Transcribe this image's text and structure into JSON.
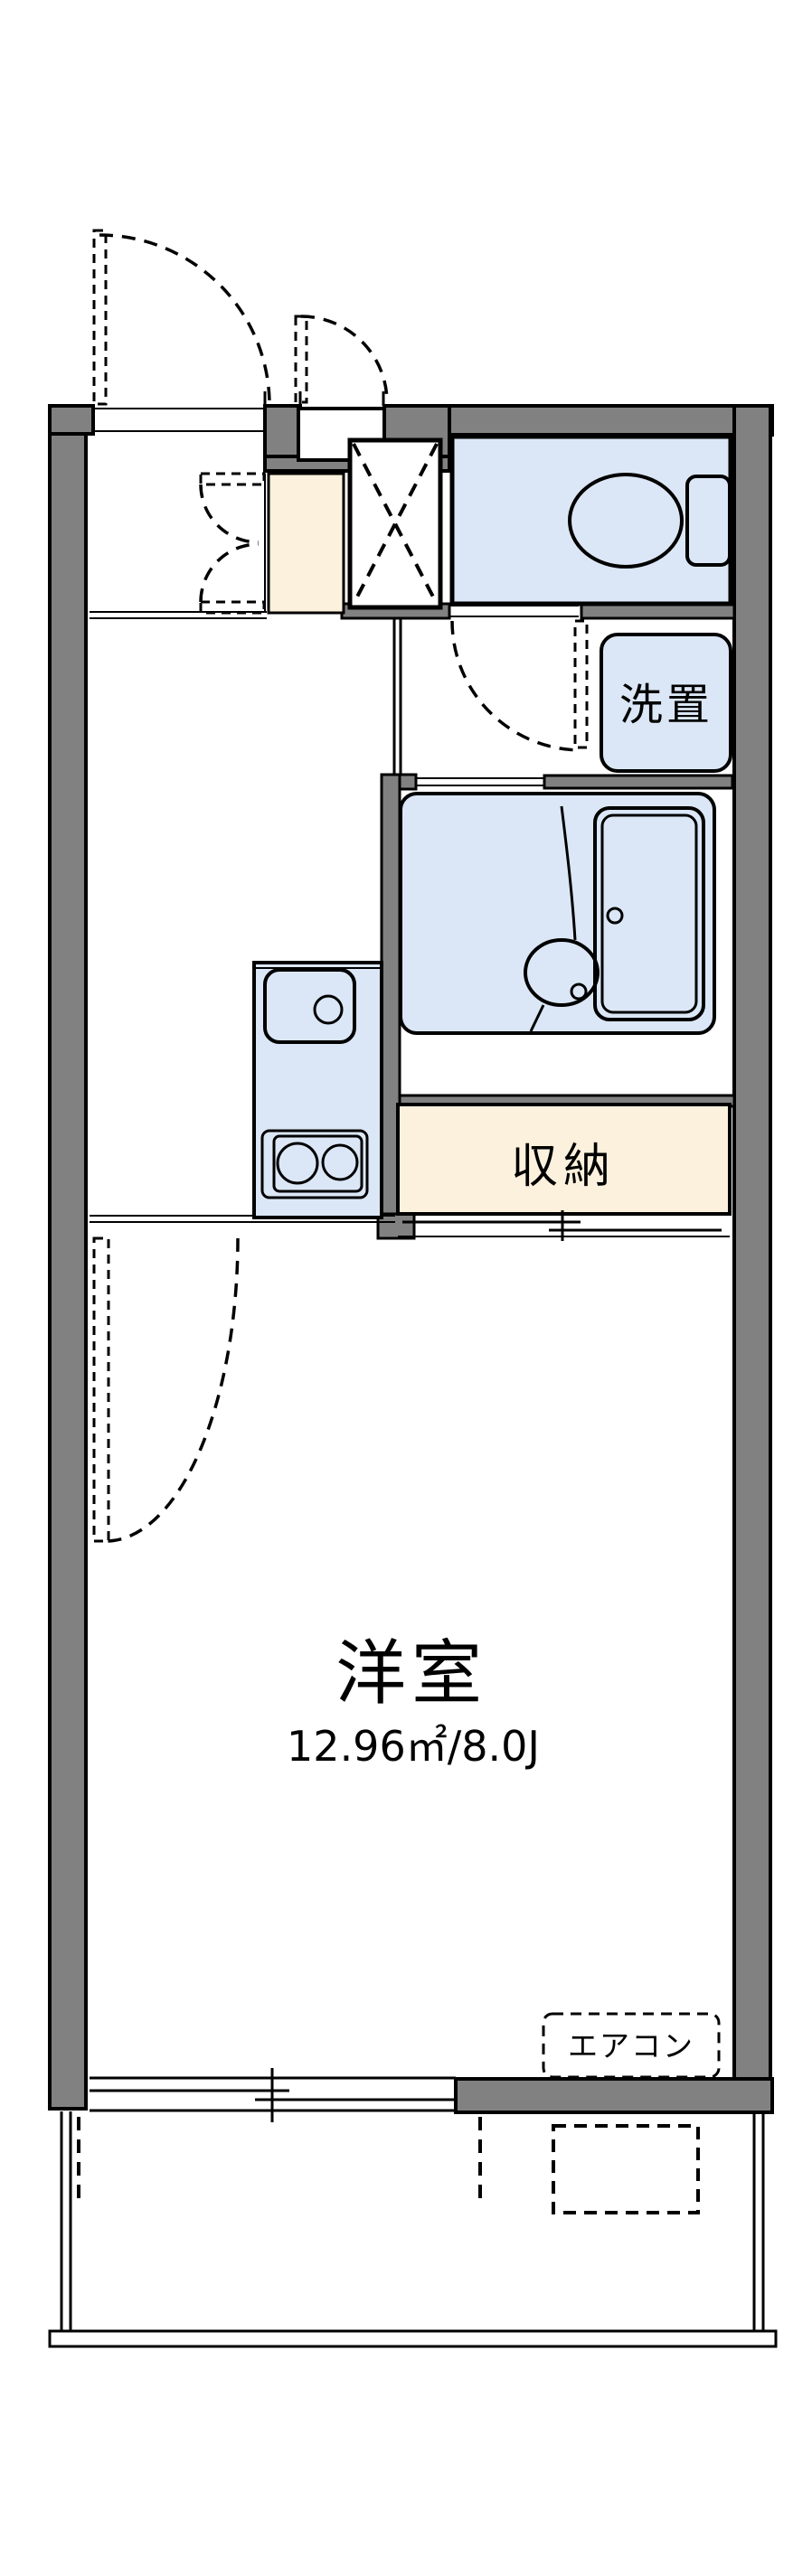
{
  "colors": {
    "wall": "#818181",
    "fixture_fill": "#dbe7f6",
    "storage_fill": "#fcf1dc",
    "line": "#000000",
    "bg": "#ffffff"
  },
  "plan": {
    "main_room": {
      "label": "洋室",
      "area": "12.96㎡/8.0J"
    },
    "storage": {
      "label": "収納"
    },
    "washer_space": {
      "label": "洗置"
    },
    "air_conditioner": {
      "label": "エアコン"
    }
  }
}
